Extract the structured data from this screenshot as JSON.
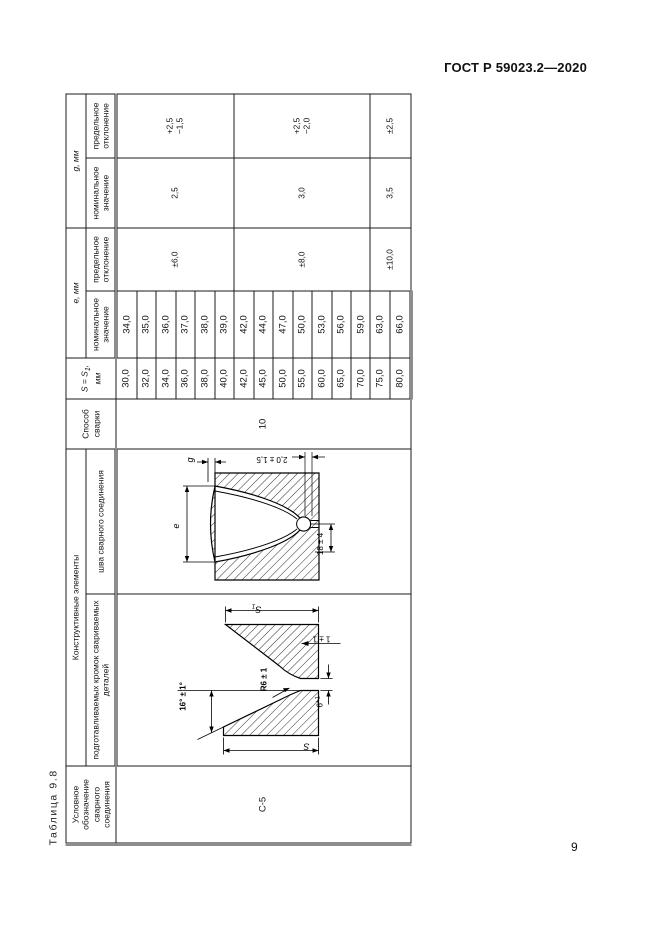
{
  "page": {
    "header": "ГОСТ Р 59023.2—2020",
    "number": "9"
  },
  "table": {
    "caption": "Таблица 9.8",
    "headers": {
      "designation": "Условное обозначение сварного соединения",
      "construct": "Конструктивные элементы",
      "edges": "подготавливаемых кромок свариваемых деталей",
      "seam": "шва сварного соединения",
      "method": "Способ сварки",
      "s_prefix": "S = S",
      "s_sub": "1",
      "s_suffix": ", мм",
      "e_group": "е, мм",
      "g_group": "g, мм",
      "nominal": "номинальное значение",
      "tolerance": "предельное отклонение"
    },
    "merged": {
      "designation": "С-5",
      "method": "10"
    },
    "groups": [
      {
        "span": 6,
        "e_tol": "±6,0",
        "g_nom": "2,5",
        "g_tol_plus": "+2,5",
        "g_tol_minus": "−1,5"
      },
      {
        "span": 7,
        "e_tol": "±8,0",
        "g_nom": "3,0",
        "g_tol_plus": "+2,5",
        "g_tol_minus": "−2,0"
      },
      {
        "span": 2,
        "e_tol": "±10,0",
        "g_nom": "3,5",
        "g_tol_plus": "±2,5",
        "g_tol_minus": ""
      }
    ],
    "rows": [
      {
        "s": "30,0",
        "e": "34,0"
      },
      {
        "s": "32,0",
        "e": "35,0"
      },
      {
        "s": "34,0",
        "e": "36,0"
      },
      {
        "s": "36,0",
        "e": "37,0"
      },
      {
        "s": "38,0",
        "e": "38,0"
      },
      {
        "s": "40,0",
        "e": "39,0"
      },
      {
        "s": "42,0",
        "e": "42,0"
      },
      {
        "s": "45,0",
        "e": "44,0"
      },
      {
        "s": "50,0",
        "e": "47,0"
      },
      {
        "s": "55,0",
        "e": "50,0"
      },
      {
        "s": "60,0",
        "e": "53,0"
      },
      {
        "s": "65,0",
        "e": "56,0"
      },
      {
        "s": "70,0",
        "e": "59,0"
      },
      {
        "s": "75,0",
        "e": "63,0"
      },
      {
        "s": "80,0",
        "e": "66,0"
      }
    ]
  },
  "diagrams": {
    "edges": {
      "thickness_top": "S",
      "thickness_top_sub": "1",
      "thickness_bottom": "S",
      "angle": "16° ± 1°",
      "radius": "R6 ± 1",
      "root_face": "1 ± 1",
      "gap_value": "6",
      "gap_tol": "+1"
    },
    "seam": {
      "reinforcement": "g",
      "width": "е",
      "offset": "2,0 ± 1,5",
      "root_width": "18 ± 4"
    }
  }
}
